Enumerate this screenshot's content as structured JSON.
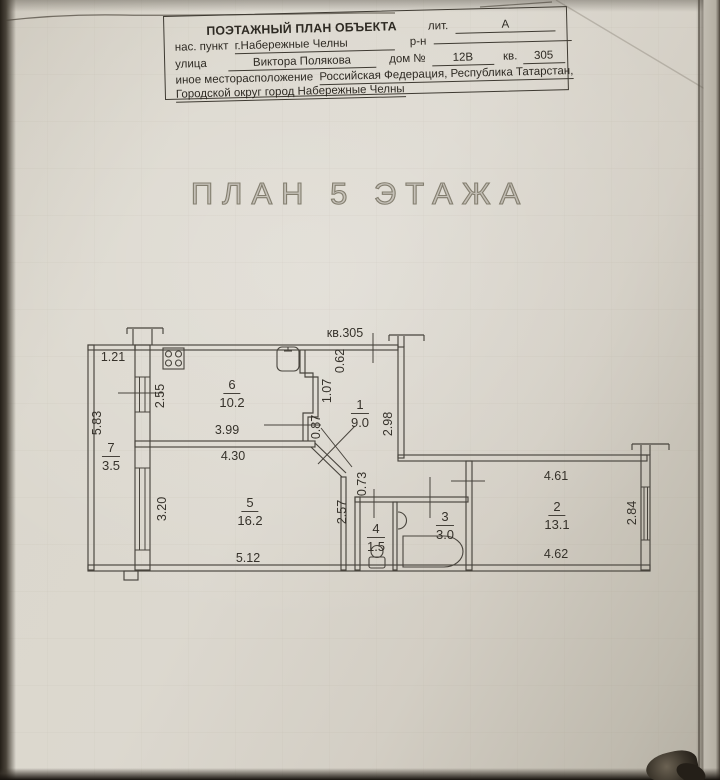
{
  "header": {
    "title": "ПОЭТАЖНЫЙ ПЛАН ОБЪЕКТА",
    "lit_label": "лит.",
    "lit_value": "А",
    "settlement_label": "нас. пункт",
    "settlement_value": "г.Набережные Челны",
    "district_label": "р-н",
    "district_value": "",
    "street_label": "улица",
    "street_value": "Виктора Полякова",
    "house_label": "дом №",
    "house_value": "12В",
    "apt_label": "кв.",
    "apt_value": "305",
    "other_location_label": "иное месторасположение",
    "other_location_value": "Российская Федерация, Республика Татарстан,",
    "other_location_value2": "Городской округ город Набережные Челны"
  },
  "plan": {
    "title": "ПЛАН 5 ЭТАЖА",
    "apartment_label": "кв.305",
    "rooms": [
      {
        "num": "1",
        "area": "9.0",
        "x": 360,
        "y": 396
      },
      {
        "num": "2",
        "area": "13.1",
        "x": 557,
        "y": 498
      },
      {
        "num": "3",
        "area": "3.0",
        "x": 445,
        "y": 508
      },
      {
        "num": "4",
        "area": "1.5",
        "x": 376,
        "y": 520
      },
      {
        "num": "5",
        "area": "16.2",
        "x": 250,
        "y": 494
      },
      {
        "num": "6",
        "area": "10.2",
        "x": 232,
        "y": 376
      },
      {
        "num": "7",
        "area": "3.5",
        "x": 111,
        "y": 439
      }
    ],
    "dims": [
      {
        "text": "1.21",
        "x": 113,
        "y": 357,
        "v": false
      },
      {
        "text": "5.83",
        "x": 97,
        "y": 423,
        "v": true
      },
      {
        "text": "2.55",
        "x": 160,
        "y": 396,
        "v": true
      },
      {
        "text": "3.99",
        "x": 227,
        "y": 430,
        "v": false
      },
      {
        "text": "4.30",
        "x": 233,
        "y": 456,
        "v": false
      },
      {
        "text": "3.20",
        "x": 162,
        "y": 509,
        "v": true
      },
      {
        "text": "5.12",
        "x": 248,
        "y": 558,
        "v": false
      },
      {
        "text": "2.57",
        "x": 342,
        "y": 512,
        "v": true
      },
      {
        "text": "0.73",
        "x": 362,
        "y": 484,
        "v": true
      },
      {
        "text": "0.87",
        "x": 316,
        "y": 427,
        "v": true
      },
      {
        "text": "1.07",
        "x": 327,
        "y": 391,
        "v": true
      },
      {
        "text": "0.62",
        "x": 340,
        "y": 361,
        "v": true
      },
      {
        "text": "2.98",
        "x": 388,
        "y": 424,
        "v": true
      },
      {
        "text": "4.61",
        "x": 556,
        "y": 476,
        "v": false
      },
      {
        "text": "4.62",
        "x": 556,
        "y": 554,
        "v": false
      },
      {
        "text": "2.84",
        "x": 632,
        "y": 513,
        "v": true
      }
    ],
    "colors": {
      "ink": "#48443d",
      "paper": "#dcd8cf",
      "title_gray": "#837e6f"
    }
  }
}
